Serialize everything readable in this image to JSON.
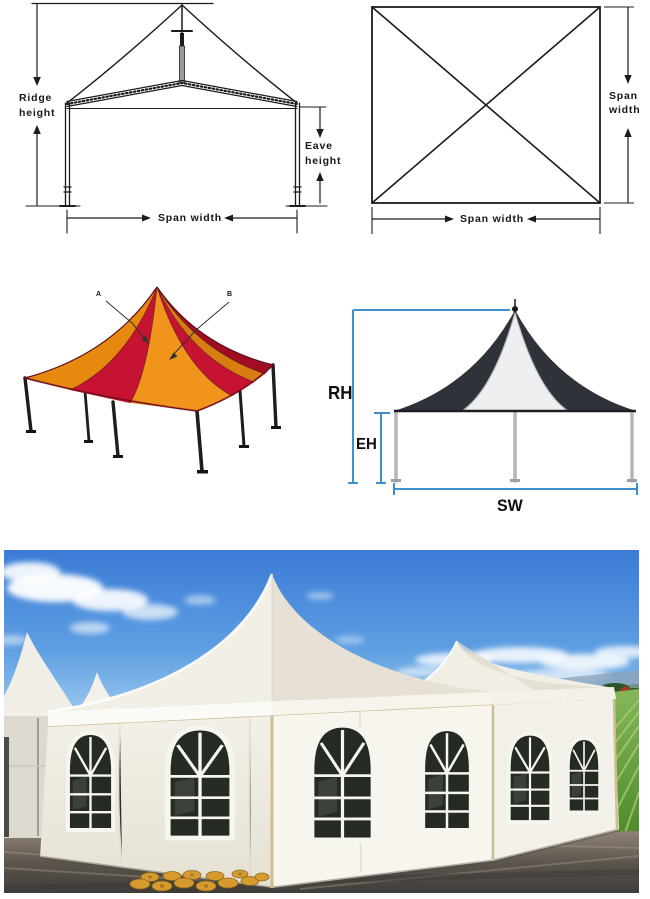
{
  "labels": {
    "side_view": {
      "ridge": "Ridge height",
      "eave": "Eave height",
      "span": "Span width"
    },
    "top_view": {
      "span_right": "Span width",
      "span_bottom": "Span width"
    },
    "render": {
      "callout_a": "A",
      "callout_b": "B"
    },
    "measured": {
      "ridge_height": "RH",
      "eave_height": "EH",
      "span_width": "SW"
    }
  },
  "colors": {
    "line_black": "#1c1c1c",
    "dimension_blue": "#3e8ecb",
    "tent_red": "#c61331",
    "tent_red_dark": "#a30d24",
    "tent_orange": "#f0941c",
    "tent_orange_dark": "#d87d10",
    "tent_orange_deep": "#e8890f",
    "canopy_dark": "#2f3238",
    "canopy_white": "#edeff0",
    "frame_gray": "#b3b7bc",
    "sky_blue_top": "#3b7bd6",
    "sky_blue_horizon": "#d4eaf7",
    "field_green": "#6aa63f",
    "ground_brown": "#6b6258",
    "fabric_white": "#f4f2ea",
    "sandbag_tan": "#d79a2e",
    "pole_tan": "#cdbf92"
  }
}
